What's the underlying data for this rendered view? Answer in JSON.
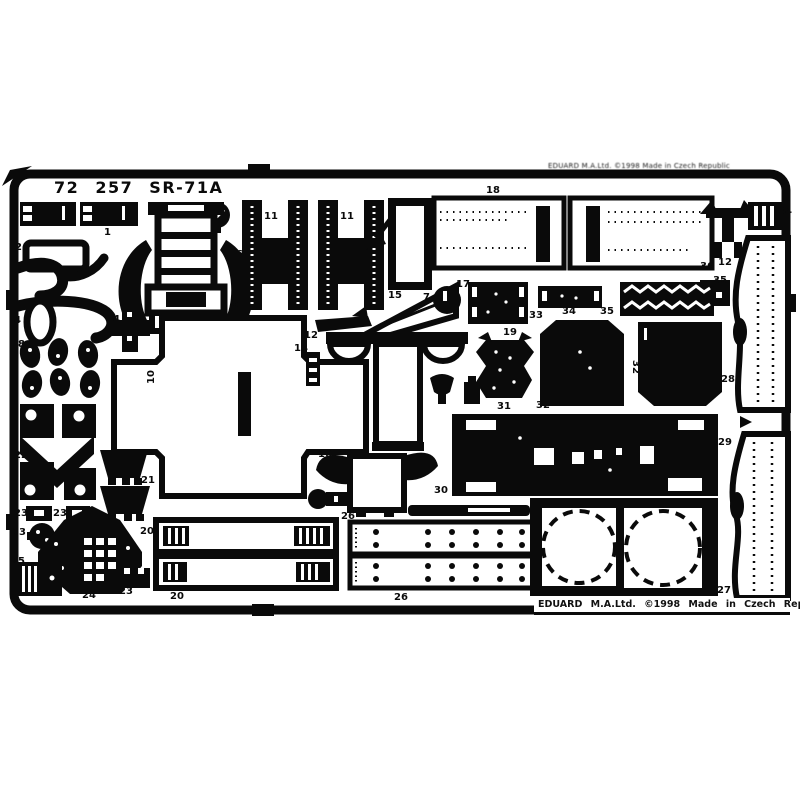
{
  "sheet": {
    "title": "72 257 SR-71A",
    "edge_text_top": "EDUARD M.A.Ltd.  ©1998  Made in Czech Republic",
    "edge_text_bottom": "EDUARD M.A.Ltd.   ©1998   Made in Czech Republic",
    "material_color": "#0a0a0a",
    "background_color": "#ffffff",
    "subject": "photo-etched parts fret scan"
  },
  "part_labels": [
    {
      "t": "1",
      "x": 104,
      "y": 228
    },
    {
      "t": "7",
      "x": 210,
      "y": 229
    },
    {
      "t": "2",
      "x": 15,
      "y": 243
    },
    {
      "t": "3",
      "x": 15,
      "y": 266
    },
    {
      "t": "4",
      "x": 14,
      "y": 316
    },
    {
      "t": "4",
      "x": 113,
      "y": 315
    },
    {
      "t": "6",
      "x": 236,
      "y": 250
    },
    {
      "t": "5",
      "x": 232,
      "y": 300
    },
    {
      "t": "8",
      "x": 18,
      "y": 340
    },
    {
      "t": "9",
      "x": 58,
      "y": 340
    },
    {
      "t": "10",
      "x": 145,
      "y": 372,
      "r": -90
    },
    {
      "t": "11",
      "x": 264,
      "y": 212
    },
    {
      "t": "11",
      "x": 340,
      "y": 212
    },
    {
      "t": "18",
      "x": 486,
      "y": 186
    },
    {
      "t": "12",
      "x": 718,
      "y": 258
    },
    {
      "t": "34",
      "x": 778,
      "y": 207
    },
    {
      "t": "36",
      "x": 700,
      "y": 262
    },
    {
      "t": "35",
      "x": 713,
      "y": 276
    },
    {
      "t": "15",
      "x": 388,
      "y": 291
    },
    {
      "t": "7",
      "x": 423,
      "y": 293
    },
    {
      "t": "17",
      "x": 456,
      "y": 280
    },
    {
      "t": "12",
      "x": 304,
      "y": 331
    },
    {
      "t": "14",
      "x": 294,
      "y": 344
    },
    {
      "t": "33",
      "x": 529,
      "y": 311
    },
    {
      "t": "34",
      "x": 562,
      "y": 307
    },
    {
      "t": "35",
      "x": 600,
      "y": 307
    },
    {
      "t": "19",
      "x": 503,
      "y": 328
    },
    {
      "t": "31",
      "x": 497,
      "y": 402
    },
    {
      "t": "32",
      "x": 536,
      "y": 401
    },
    {
      "t": "32",
      "x": 628,
      "y": 362,
      "r": 90
    },
    {
      "t": "30",
      "x": 434,
      "y": 486
    },
    {
      "t": "28",
      "x": 721,
      "y": 375
    },
    {
      "t": "29",
      "x": 718,
      "y": 438
    },
    {
      "t": "16",
      "x": 318,
      "y": 450
    },
    {
      "t": "22",
      "x": 14,
      "y": 451
    },
    {
      "t": "21",
      "x": 141,
      "y": 476
    },
    {
      "t": "23",
      "x": 14,
      "y": 509
    },
    {
      "t": "23",
      "x": 53,
      "y": 509
    },
    {
      "t": "13",
      "x": 12,
      "y": 528
    },
    {
      "t": "20",
      "x": 140,
      "y": 527
    },
    {
      "t": "20",
      "x": 170,
      "y": 592
    },
    {
      "t": "25",
      "x": 11,
      "y": 557
    },
    {
      "t": "24",
      "x": 82,
      "y": 591
    },
    {
      "t": "23",
      "x": 119,
      "y": 587
    },
    {
      "t": "26",
      "x": 341,
      "y": 512
    },
    {
      "t": "26",
      "x": 394,
      "y": 593
    },
    {
      "t": "27",
      "x": 717,
      "y": 586
    }
  ]
}
